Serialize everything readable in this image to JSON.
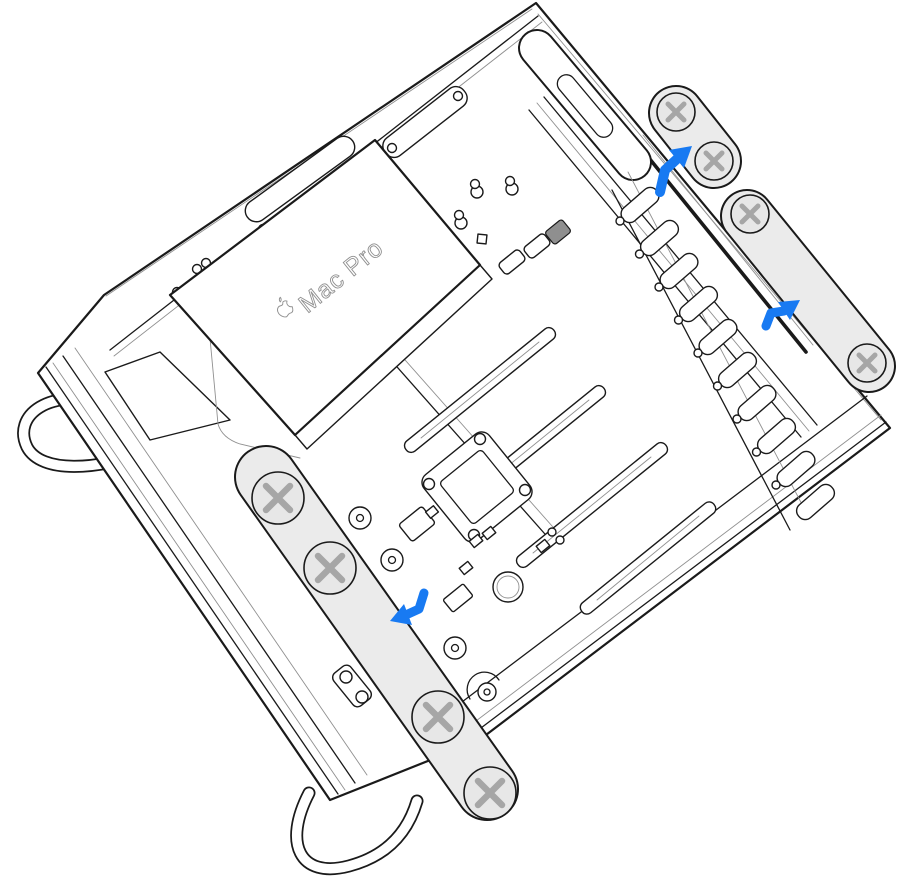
{
  "illustration": {
    "device": "Mac Pro",
    "scene": "Mac Pro lying on its side with side panel removed, internal components exposed; two slide brackets removed upward on the right, one slide rail sliding off toward the lower left",
    "label": {
      "text": "Mac Pro",
      "icon": "apple-logo-icon"
    },
    "parts": [
      {
        "name": "top-latch-bracket",
        "state": "removed",
        "visible_screws": 2
      },
      {
        "name": "right-slide-rail",
        "state": "removed",
        "visible_screws": 2
      },
      {
        "name": "left-slide-rail",
        "state": "sliding-off",
        "visible_screws": 4
      },
      {
        "name": "power-supply-cover",
        "state": "installed"
      },
      {
        "name": "pcie-slots",
        "count": 4
      },
      {
        "name": "dimm-latch-ladder",
        "count": 10
      },
      {
        "name": "cpu-socket",
        "state": "installed"
      },
      {
        "name": "battery",
        "state": "installed"
      },
      {
        "name": "chassis-feet",
        "count": 2
      }
    ],
    "arrows": [
      {
        "id": "arrow-up-right-1",
        "direction": "up-right"
      },
      {
        "id": "arrow-up-right-2",
        "direction": "up-right"
      },
      {
        "id": "arrow-down-left-1",
        "direction": "down-left"
      }
    ],
    "colors": {
      "background": "#ffffff",
      "line": "#1a1a1a",
      "subtle": "#909090",
      "metal": "#ebebeb",
      "screw_fill": "#e7e7e7",
      "screw_cross": "#a6a6a6",
      "arrow_blue": "#187af2"
    }
  }
}
